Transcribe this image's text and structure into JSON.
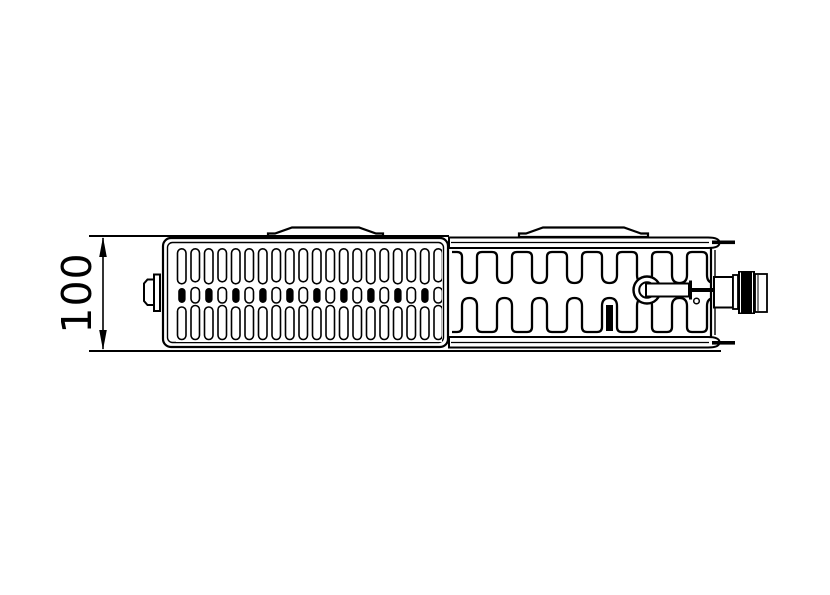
{
  "drawing": {
    "type": "technical-drawing",
    "subject": "panel-radiator-top-view",
    "dimension_label": "100",
    "line_color": "#000000",
    "background_color": "#ffffff"
  }
}
